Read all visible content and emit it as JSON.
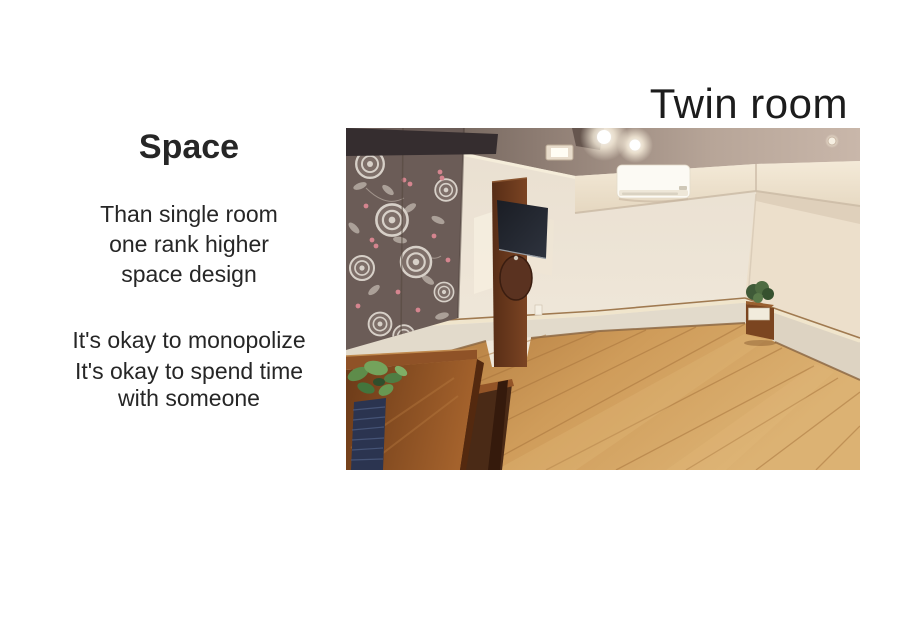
{
  "slide": {
    "background_color": "#ffffff",
    "title": "Twin room",
    "title_color": "#1c1c1c",
    "left_panel": {
      "heading": "Space",
      "paragraph1_lines": [
        "Than single room",
        "one rank higher",
        "space design"
      ],
      "paragraph2_lines": [
        "It's okay to monopolize",
        "It's okay to spend time",
        "with someone"
      ],
      "text_color": "#262626"
    },
    "photo_colors": {
      "wall": "#efe7d9",
      "ceiling": "#8d7c72",
      "floor": "#c9914e",
      "wood_panel": "#6b3a1e",
      "wallpaper": "#6b5c57",
      "wallpaper_rose": "#d7d0c8",
      "wallpaper_berry": "#d5858f"
    }
  }
}
